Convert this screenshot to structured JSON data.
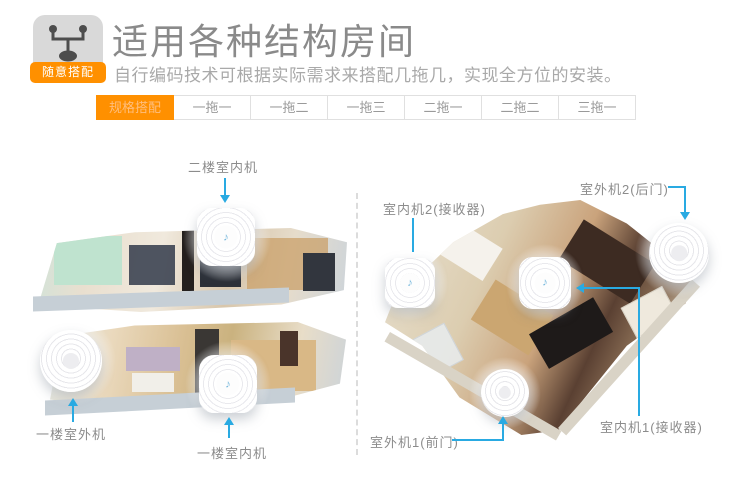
{
  "header": {
    "icon": "splitter-icon",
    "badge": "随意搭配",
    "title": "适用各种结构房间",
    "subtitle": "自行编码技术可根据实际需求来搭配几拖几，实现全方位的安装。"
  },
  "tabs": {
    "active": "规格搭配",
    "items": [
      "一拖一",
      "一拖二",
      "一拖三",
      "二拖一",
      "二拖二",
      "三拖一"
    ]
  },
  "annotations": {
    "left_house": [
      "二楼室内机",
      "一楼室外机",
      "一楼室内机"
    ],
    "right_house": [
      "室内机2(接收器)",
      "室外机2(后门)",
      "室外机1(前门)",
      "室内机1(接收器)"
    ]
  },
  "device_glyphs": {
    "note": "♪"
  },
  "colors": {
    "accent_orange": "#ff9000",
    "leader_blue": "#29aae2",
    "title_gray": "#8a8a8a",
    "subtitle_gray": "#a9a9a9",
    "tab_text_gray": "#9a9a9a"
  }
}
